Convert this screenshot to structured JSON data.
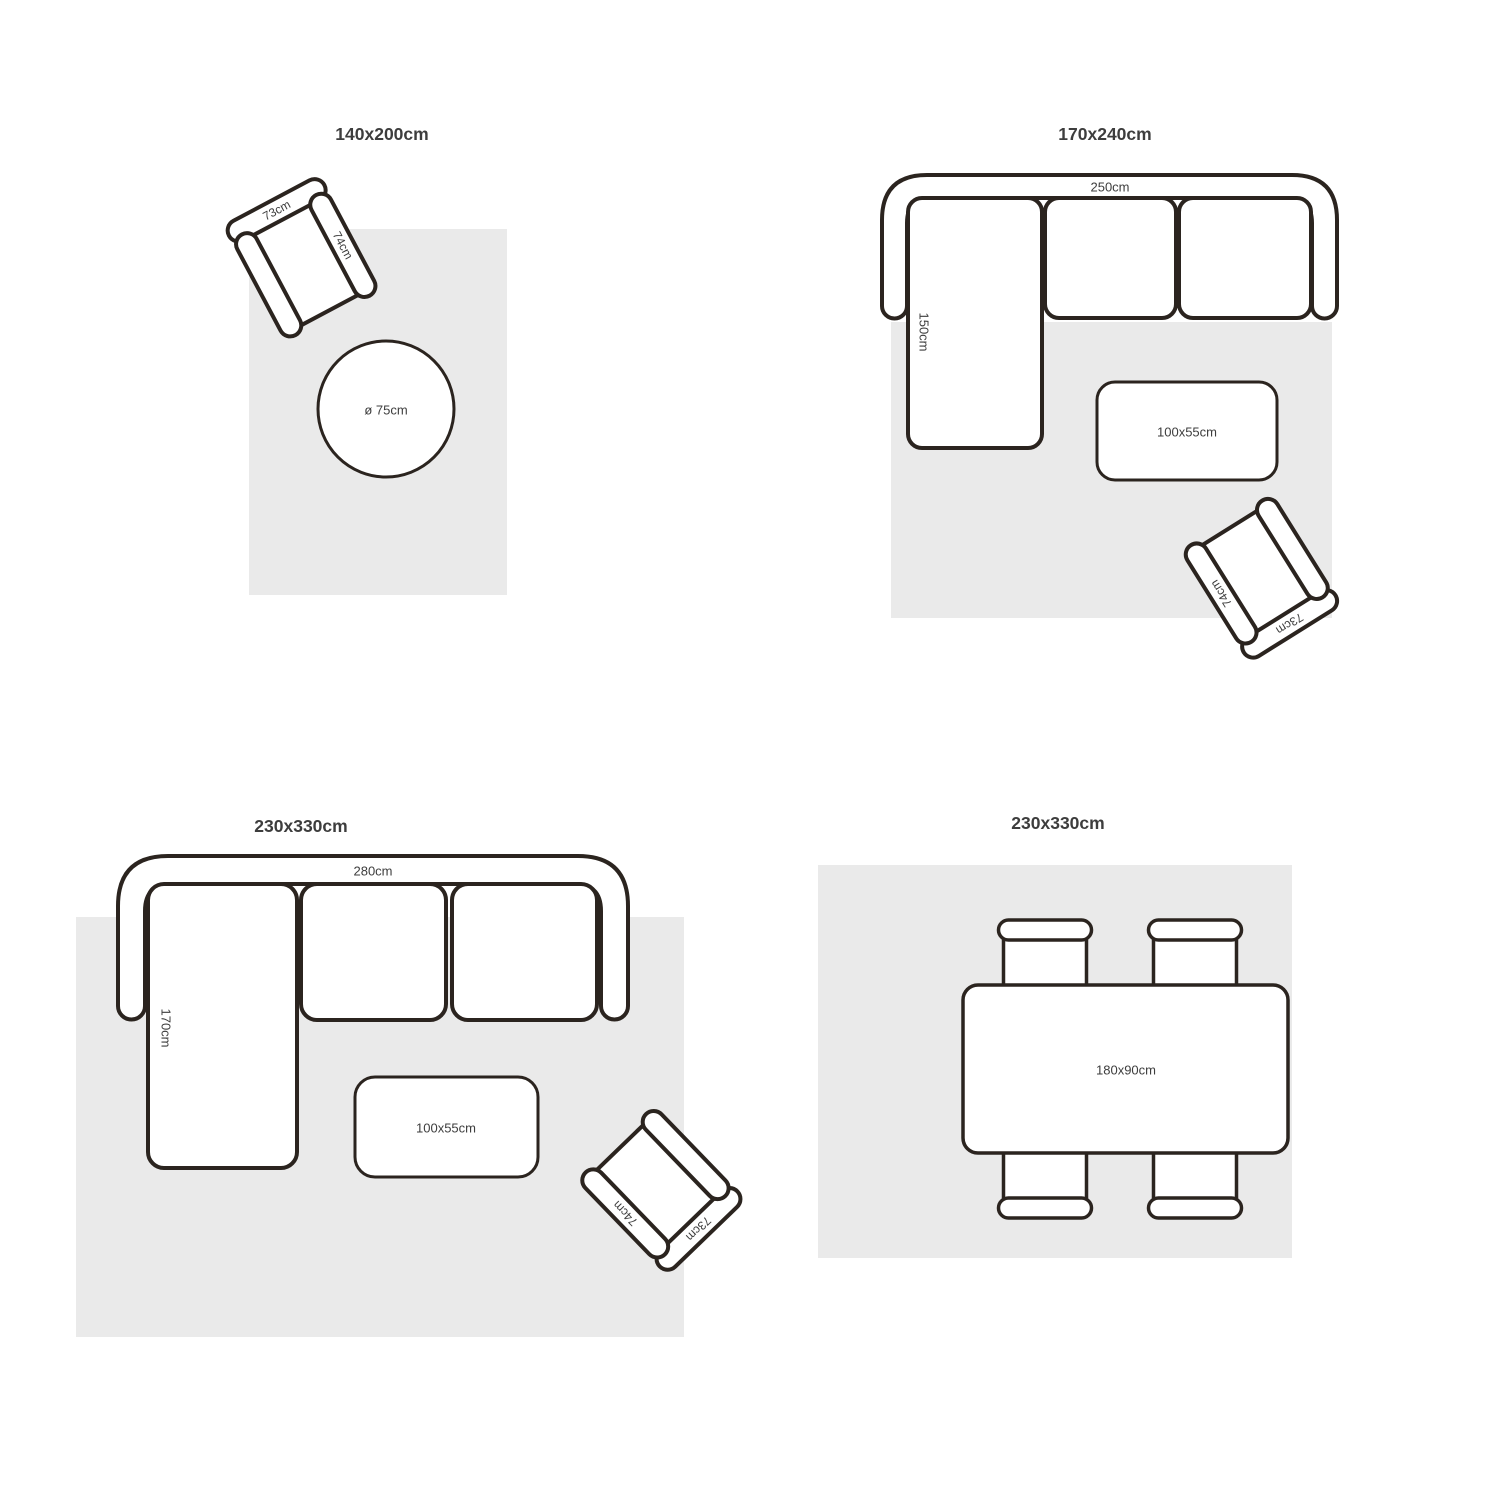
{
  "colors": {
    "background": "#ffffff",
    "rug": "#eaeaea",
    "outline": "#2b241f",
    "text": "#3d3d3d",
    "furniture_fill": "#ffffff"
  },
  "panels": [
    {
      "id": "rug-140x200",
      "title": "140x200cm",
      "armchair": {
        "back_label": "73cm",
        "arm_label": "74cm"
      },
      "side_table": {
        "label": "ø 75cm"
      }
    },
    {
      "id": "rug-170x240",
      "title": "170x240cm",
      "sofa": {
        "width_label": "250cm",
        "chaise_label": "150cm"
      },
      "coffee_table": {
        "label": "100x55cm"
      },
      "armchair": {
        "back_label": "73cm",
        "arm_label": "74cm"
      }
    },
    {
      "id": "rug-230x330-sofa",
      "title": "230x330cm",
      "sofa": {
        "width_label": "280cm",
        "chaise_label": "170cm"
      },
      "coffee_table": {
        "label": "100x55cm"
      },
      "armchair": {
        "back_label": "73cm",
        "arm_label": "74cm"
      }
    },
    {
      "id": "rug-230x330-dining",
      "title": "230x330cm",
      "dining_table": {
        "label": "180x90cm"
      }
    }
  ]
}
